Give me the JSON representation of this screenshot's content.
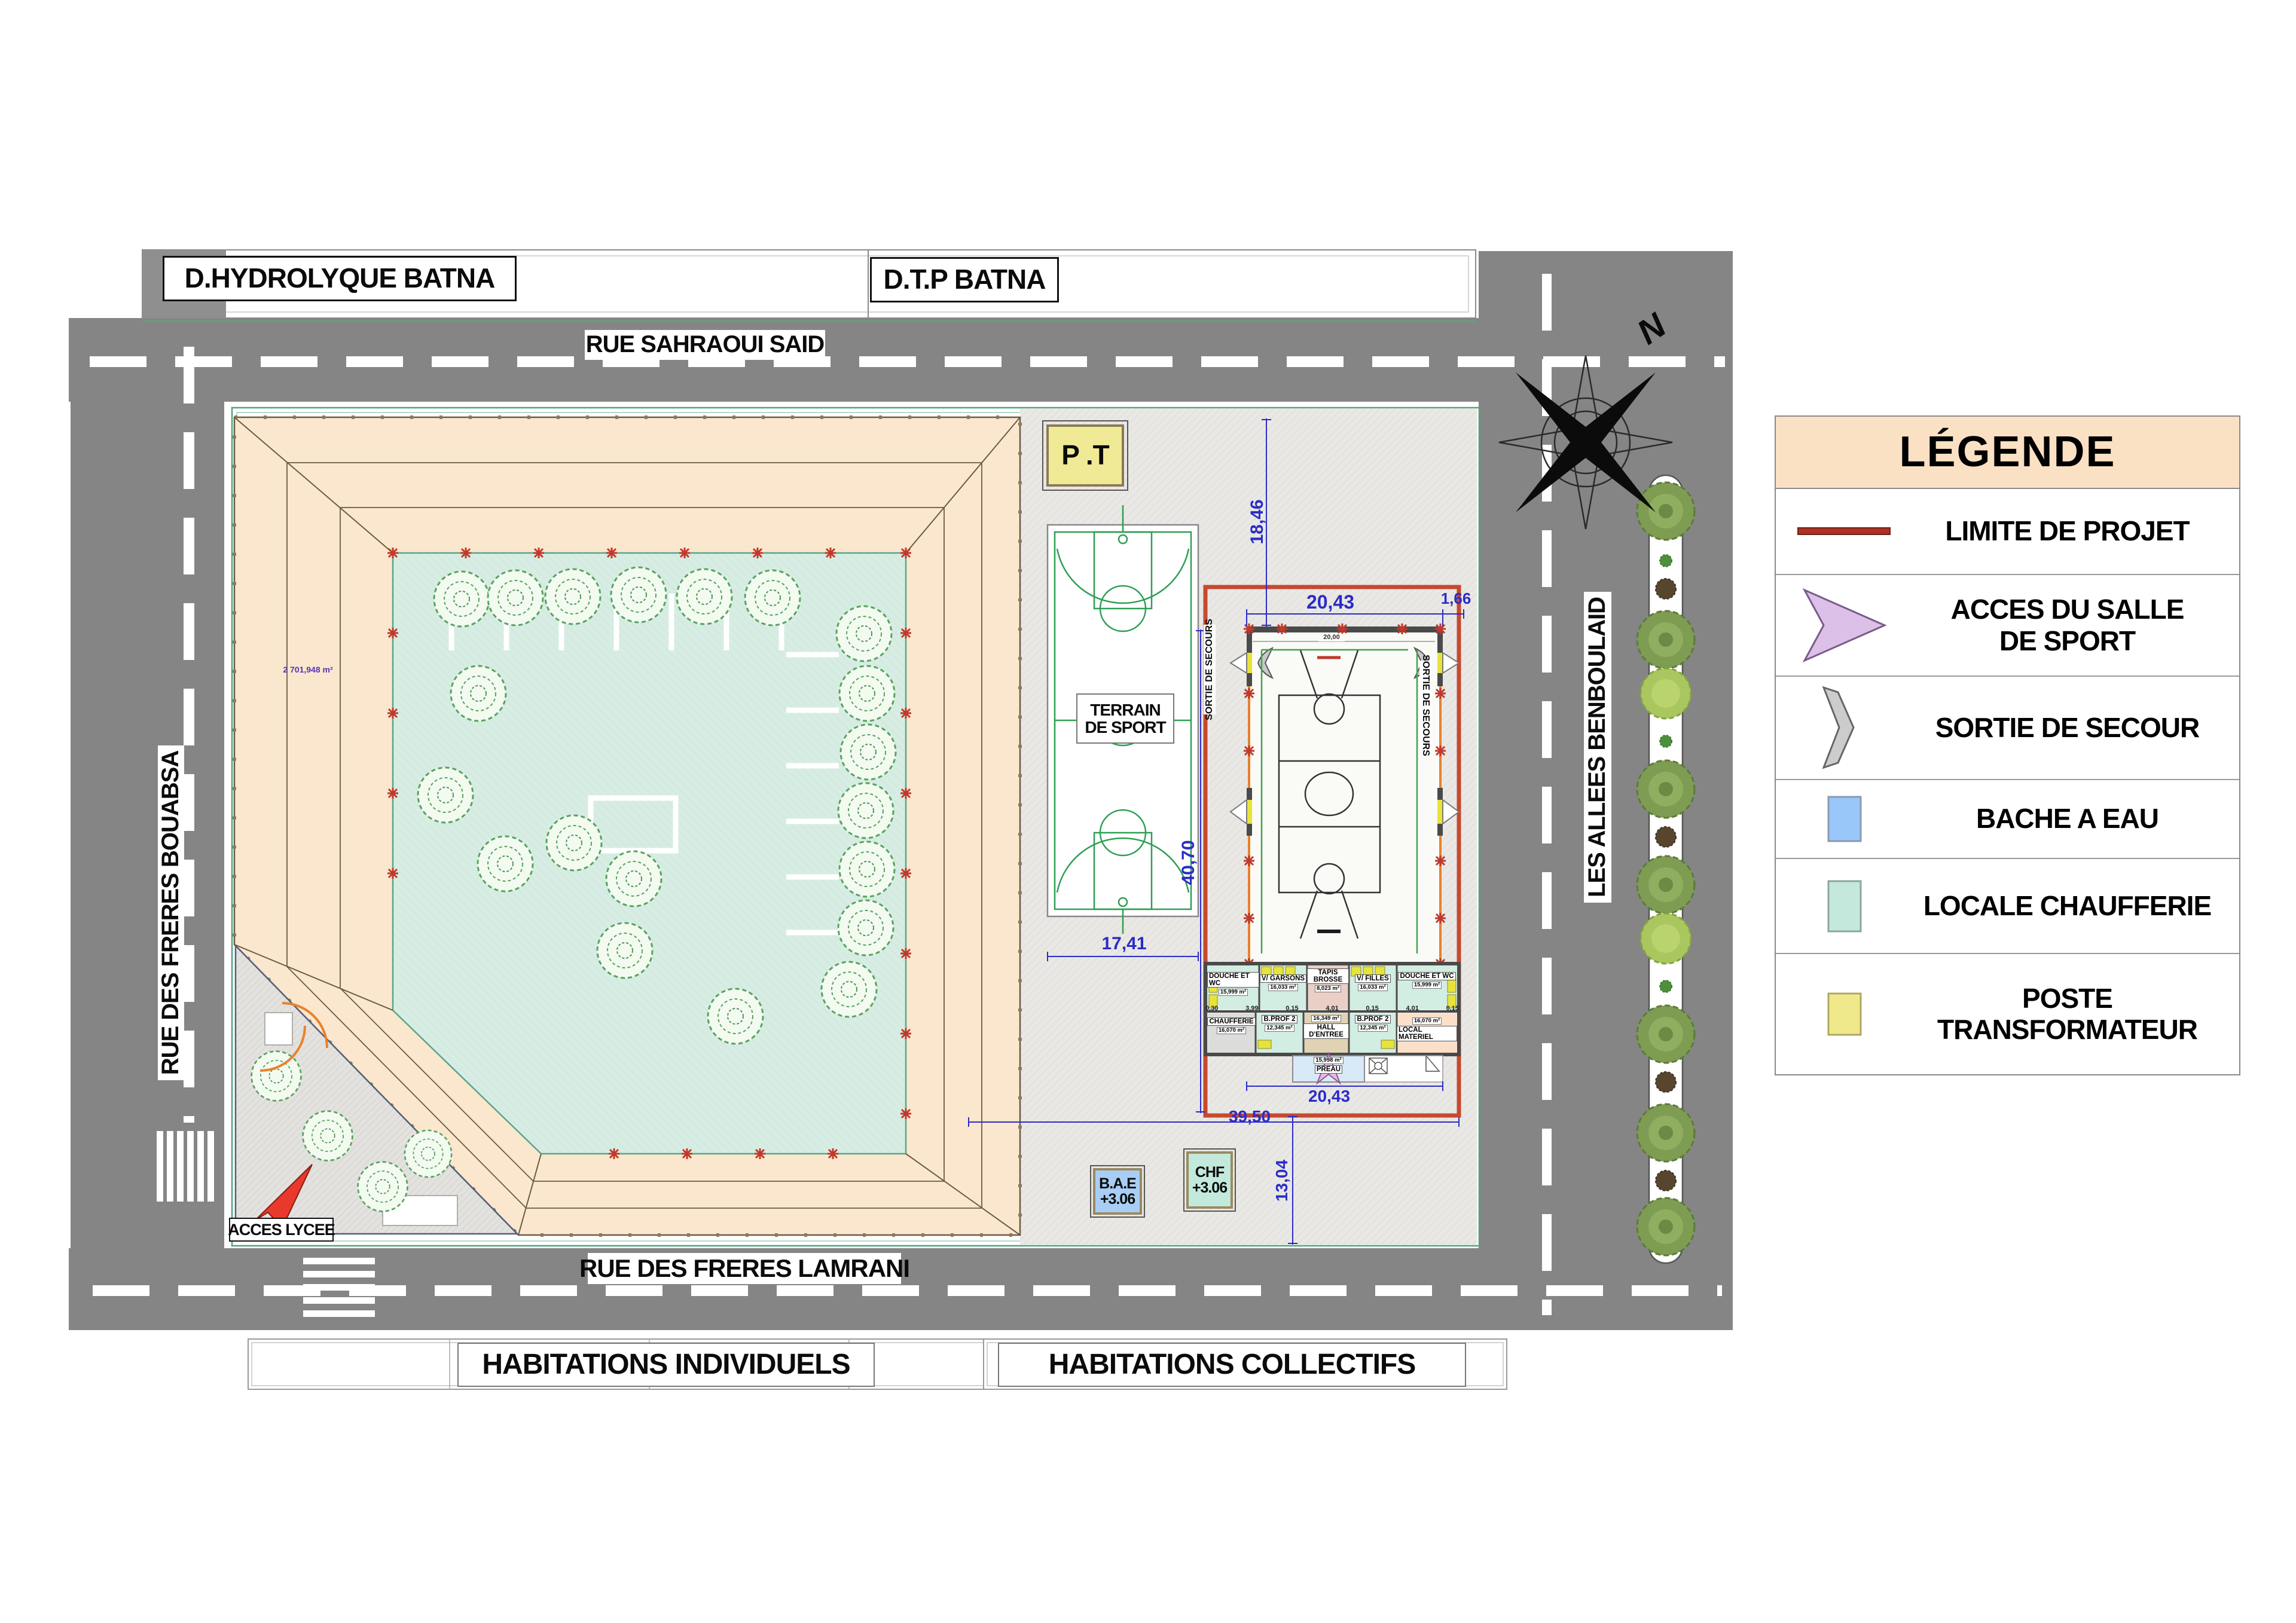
{
  "plan": {
    "streets": {
      "top": "RUE SAHRAOUI SAID",
      "left": "RUE DES FRERES BOUABSA",
      "bottom": "RUE DES FRERES LAMRANI",
      "right": "LES ALLEES BENBOULAID"
    },
    "parcels": {
      "top_left": "D.HYDROLYQUE BATNA",
      "top_right": "D.T.P BATNA",
      "bottom_left": "HABITATIONS INDIVIDUELS",
      "bottom_right": "HABITATIONS COLLECTIFS"
    },
    "labels": {
      "acces_lycee": "ACCES LYCEE",
      "terrain_line1": "TERRAIN",
      "terrain_line2": "DE SPORT",
      "pt": "P .T",
      "courtyard_area": "2 701,948 m²",
      "north": "N"
    },
    "bae": {
      "name": "B.A.E",
      "level": "+3.06"
    },
    "chf": {
      "name": "CHF",
      "level": "+3.06"
    },
    "hall": {
      "sortie": "SORTIE DE SECOURS",
      "inner_dim": "20,00",
      "rooms_row1": [
        {
          "name": "DOUCHE ET WC",
          "area": "15,999 m²"
        },
        {
          "name": "V/ GARSONS",
          "area": "16,033 m²"
        },
        {
          "name": "TAPIS BROSSE",
          "area": "8,023 m²"
        },
        {
          "name": "V/ FILLES",
          "area": "16,033 m²"
        },
        {
          "name": "DOUCHE ET WC",
          "area": "15,999 m²"
        }
      ],
      "rooms_row2": [
        {
          "name": "CHAUFFERIE",
          "area": "16,070 m²"
        },
        {
          "name": "B.PROF 2",
          "area": "12,345 m²"
        },
        {
          "name": "HALL D'ENTREE",
          "area": "16,349 m²"
        },
        {
          "name": "B.PROF 2",
          "area": "12,345 m²"
        },
        {
          "name": "LOCAL MATERIEL",
          "area": "16,070 m²"
        }
      ],
      "preau": {
        "name": "PREAU",
        "area": "15,998 m²"
      },
      "wall_dims": [
        "0,30",
        "3,99",
        "0,15",
        "4,01",
        "0,15",
        "4,01",
        "0,15"
      ]
    },
    "dimensions": {
      "top_offset": "18,46",
      "hall_width_top": "20,43",
      "edge": "1,66",
      "hall_height": "40,70",
      "terrain_width": "17,41",
      "hall_width_bottom": "20,43",
      "site_width": "39,50",
      "bottom_offset": "13,04"
    }
  },
  "legend": {
    "title": "LÉGENDE",
    "items": [
      {
        "id": "limite",
        "label": "LIMITE DE PROJET"
      },
      {
        "id": "acces",
        "label": "ACCES DU SALLE DE SPORT",
        "line1": "ACCES DU SALLE",
        "line2": "DE SPORT"
      },
      {
        "id": "sortie",
        "label": "SORTIE DE SECOUR"
      },
      {
        "id": "bache",
        "label": "BACHE A EAU"
      },
      {
        "id": "chaufferie",
        "label": "LOCALE CHAUFFERIE"
      },
      {
        "id": "poste",
        "label": "POSTE TRANSFORMATEUR",
        "line1": "POSTE",
        "line2": "TRANSFORMATEUR"
      }
    ]
  },
  "colors": {
    "road": "#858585",
    "building": "#FAE7CD",
    "courtyard": "#D7EDE3",
    "sports_zone": "#E9E8E5",
    "project_boundary": "#C7492E",
    "bache": "#A9CEF6",
    "chaufferie_swatch": "#C2E9DC",
    "poste": "#F0EA96",
    "acces_arrow": "#DCC0E8",
    "legend_header": "#FBE1C4",
    "dimension_text": "#2B2BC8"
  }
}
